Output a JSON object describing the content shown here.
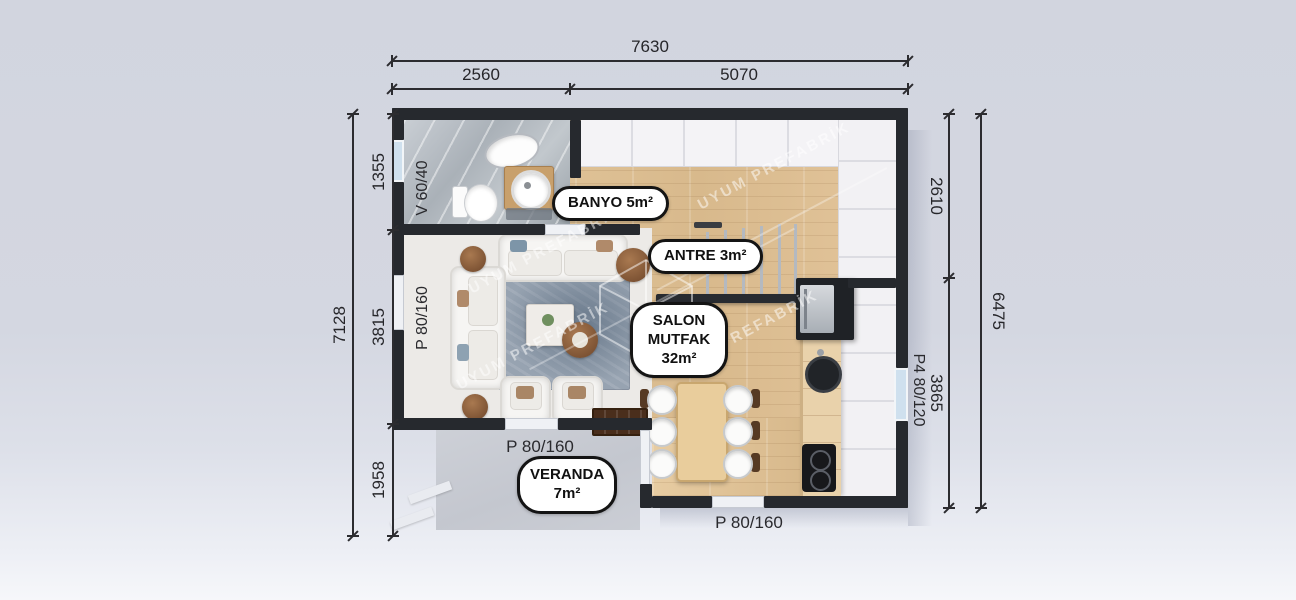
{
  "scene": {
    "type": "prefab-house-floor-plan",
    "watermark_text": "UYUM PREFABRİK",
    "colors": {
      "background": "#d4d7e1",
      "wall": "#26292e",
      "wood_floor": "#ddc096",
      "marble_floor": "#b3bac1",
      "rug": "#97a3b1",
      "veranda_concrete": "#c7cad1",
      "label_border": "#141414",
      "dimension_text": "#2a2a2e"
    }
  },
  "rooms": {
    "banyo": {
      "label": "BANYO 5m²"
    },
    "antre": {
      "label": "ANTRE 3m²"
    },
    "salon": {
      "lines": [
        "SALON",
        "MUTFAK",
        "32m²"
      ]
    },
    "veranda": {
      "lines": [
        "VERANDA",
        "7m²"
      ]
    }
  },
  "dimensions": {
    "top": {
      "total": "7630",
      "segments": [
        "2560",
        "5070"
      ]
    },
    "left": {
      "total": "7128",
      "segments": [
        "1355",
        "3815",
        "1958"
      ]
    },
    "right": {
      "total": "6475",
      "segments": [
        "2610",
        "3865"
      ]
    }
  },
  "openings": {
    "left_window": "V 60/40",
    "left_door": "P 80/160",
    "salon_door": "P 80/160",
    "kitchen_door": "P 80/160",
    "right_window": "P4 80/120"
  }
}
